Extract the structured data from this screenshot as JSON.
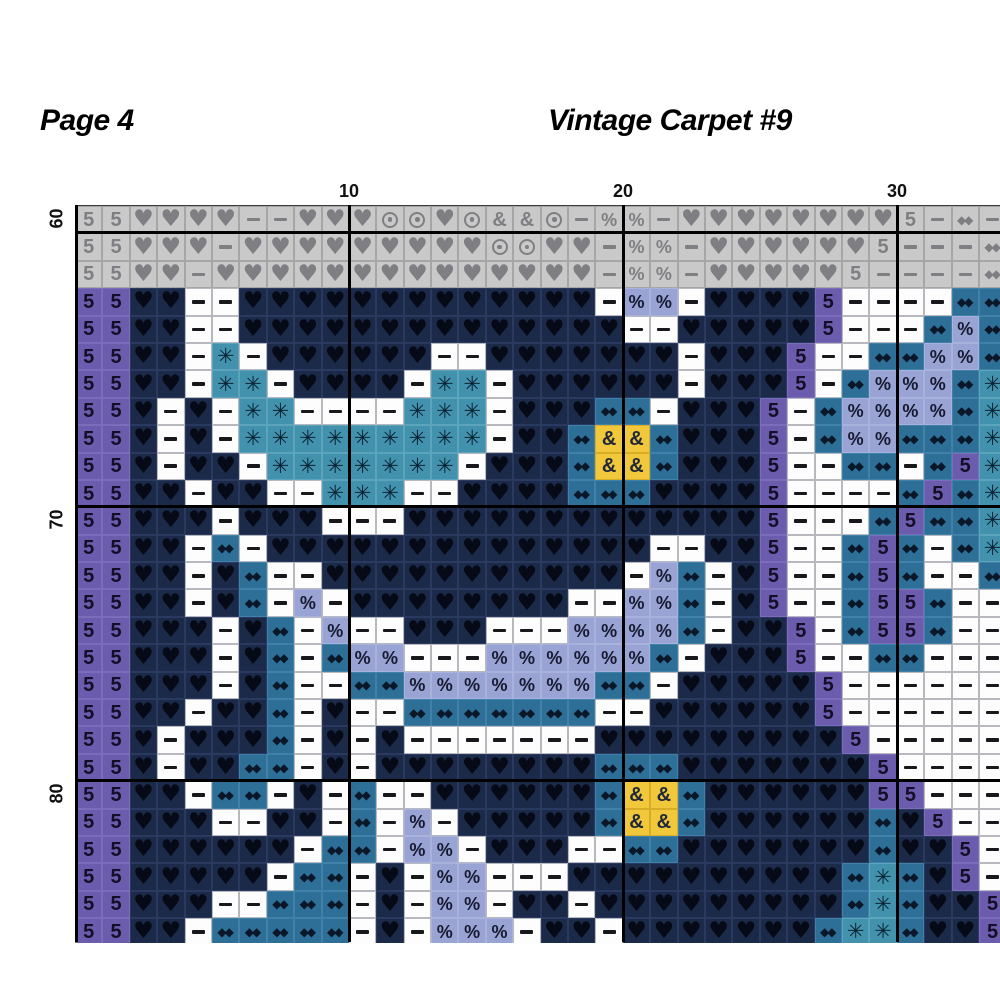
{
  "header": {
    "page_label": "Page 4",
    "title": "Vintage Carpet #9"
  },
  "axis": {
    "col_labels": [
      {
        "text": "10",
        "boundary_col": 10
      },
      {
        "text": "20",
        "boundary_col": 20
      },
      {
        "text": "30",
        "boundary_col": 30
      }
    ],
    "row_labels": [
      {
        "text": "60",
        "row_index": 0
      },
      {
        "text": "70",
        "row_index": 11
      },
      {
        "text": "80",
        "row_index": 21
      }
    ]
  },
  "palette": {
    "g": {
      "name": "gray-overlap",
      "bg": "#c9c9c9",
      "border": "#a6a6a6",
      "symbol": "#7f7f83"
    },
    "p": {
      "name": "purple",
      "bg": "#6c5cae",
      "border": "#7c6cbc",
      "symbol": "#140f26"
    },
    "n": {
      "name": "dark-navy",
      "bg": "#1c2a4a",
      "border": "#29395f",
      "symbol": "#060a16"
    },
    "w": {
      "name": "white",
      "bg": "#fdfdfe",
      "border": "#b8b8bf",
      "symbol": "#17181c"
    },
    "t": {
      "name": "teal",
      "bg": "#4392ad",
      "border": "#5ba4bc",
      "symbol": "#0a2435"
    },
    "b": {
      "name": "steel-blue",
      "bg": "#2d6f97",
      "border": "#3f81a8",
      "symbol": "#091729"
    },
    "l": {
      "name": "periwinkle",
      "bg": "#9aa4d4",
      "border": "#a9b2dd",
      "symbol": "#161a31"
    },
    "y": {
      "name": "gold",
      "bg": "#f1c83c",
      "border": "#d8ac27",
      "symbol": "#20283a"
    }
  },
  "symbols": {
    "5": "5",
    "h": "♥",
    "d": "−",
    "a": "✳",
    "p": "%",
    "o": "⊙",
    "m": "◆◆",
    "x": "&"
  },
  "grid": {
    "cols": 34,
    "rows_count": 27,
    "major_line_cols": [
      10,
      20,
      30
    ],
    "major_line_rows": [
      1,
      11,
      21
    ],
    "rows": [
      "g5 g5 gh gh gh gh gd gd gh gh gh go go gh go gx gx go gd gp gp gd gh gh gh gh gh gh gh gh g5 gd gm gd",
      "g5 g5 gh gh gh gd gh gh gh gh gh gh gh gh gh go go gh gh gd gp gp gd gh gh gh gh gh gh g5 gd gd gd gm",
      "g5 g5 gh gh gd gh gh gh gh gh gh gh gh gh gh gh gh gh gh gd gp gp gd gh gh gh gh gh g5 gd gd gd gd gm",
      "p5 p5 nh nh wd wd nh nh nh nh nh nh nh nh nh nh nh nh nh wd lp lp wd nh nh nh nh p5 wd wd wd wd bm bm",
      "p5 p5 nh nh wd wd nh nh nh nh nh nh nh nh nh nh nh nh nh nh wd wd nh nh nh nh nh p5 wd wd wd bm lp bm",
      "p5 p5 nh nh wd ta wd nh nh nh nh nh nh wd wd nh nh nh nh nh nh nh wd nh nh nh p5 wd wd bm bm lp lp bm",
      "p5 p5 nh nh wd ta ta wd nh nh nh nh wd ta ta wd nh nh nh nh nh nh wd nh nh nh p5 wd bm lp lp lp bm ta",
      "p5 p5 nh wd nh wd ta ta wd wd wd wd ta ta ta wd nh nh nh bm bm wd nh nh nh p5 wd bm lp lp lp lp bm ta",
      "p5 p5 nh wd nh wd ta ta ta ta ta ta ta ta ta wd nh nh bm yx yx bm nh nh nh p5 wd bm lp lp bm bm bm ta",
      "p5 p5 nh wd nh nh wd ta ta ta ta ta ta ta wd nh nh nh bm yx yx bm nh nh nh p5 wd wd bm bm wd bm p5 ta",
      "p5 p5 nh nh wd nh nh wd wd ta ta ta wd wd nh nh nh nh bm bm bm nh nh nh nh p5 wd wd wd wd bm p5 bm ta",
      "p5 p5 nh nh nh wd nh nh nh wd wd wd nh nh nh nh nh nh nh nh nh nh nh nh nh p5 wd wd wd bm p5 bm bm ta",
      "p5 p5 nh nh wd bm wd nh nh nh nh nh nh nh nh nh nh nh nh nh nh wd wd nh nh p5 wd wd bm p5 bm wd bm ta",
      "p5 p5 nh nh wd nh bm wd wd nh nh nh nh nh nh nh nh nh nh nh wd lp bm wd nh p5 wd wd bm p5 bm wd wd bm",
      "p5 p5 nh nh wd nh bm wd lp wd nh nh nh nh nh nh nh nh wd wd lp lp bm wd nh p5 wd wd bm p5 p5 bm wd wd",
      "p5 p5 nh nh nh wd nh bm wd lp wd wd nh nh nh wd wd wd lp lp lp lp bm wd nh nh p5 wd bm p5 p5 bm wd wd",
      "p5 p5 nh nh nh wd nh bm wd bm lp lp wd wd wd lp lp lp lp lp lp bm wd nh nh nh p5 wd wd bm bm wd wd wd",
      "p5 p5 nh nh nh wd nh bm wd wd bm bm lp lp lp lp lp lp lp bm bm wd nh nh nh nh nh p5 wd wd wd wd wd wd",
      "p5 p5 nh nh wd nh nh bm wd nh wd wd bm bm bm bm bm bm bm wd wd nh nh nh nh nh nh p5 wd wd wd wd wd wd",
      "p5 p5 nh wd nh nh nh bm wd nh wd nh wd wd wd wd wd wd wd nh nh nh nh nh nh nh nh nh p5 wd wd wd wd wd",
      "p5 p5 nh wd nh nh bm bm wd nh wd nh nh nh nh nh nh nh nh bm bm bm nh nh nh nh nh nh nh p5 wd wd wd wd",
      "p5 p5 nh nh wd bm bm wd nh wd bm wd wd nh nh nh nh nh nh bm yx yx bm nh nh nh nh nh nh p5 p5 wd wd wd",
      "p5 p5 nh nh nh wd wd nh nh wd bm wd lp wd nh nh nh nh nh bm yx yx bm nh nh nh nh nh nh bm nh p5 wd wd",
      "p5 p5 nh nh nh nh nh nh wd bm bm wd lp lp wd nh nh nh wd wd bm bm nh nh nh nh nh nh nh bm nh nh p5 wd",
      "p5 p5 nh nh nh nh nh wd bm bm wd nh wd lp lp wd wd wd nh nh nh nh nh nh nh nh nh nh bm ta bm nh p5 wd",
      "p5 p5 nh nh nh wd wd bm bm bm wd nh wd lp lp wd nh nh wd nh nh nh nh nh nh nh nh nh bm ta bm nh nh p5",
      "p5 p5 nh nh wd bm bm bm bm bm wd nh wd lp lp lp wd nh nh wd nh nh nh nh nh nh nh bm ta ta bm nh nh p5"
    ]
  }
}
